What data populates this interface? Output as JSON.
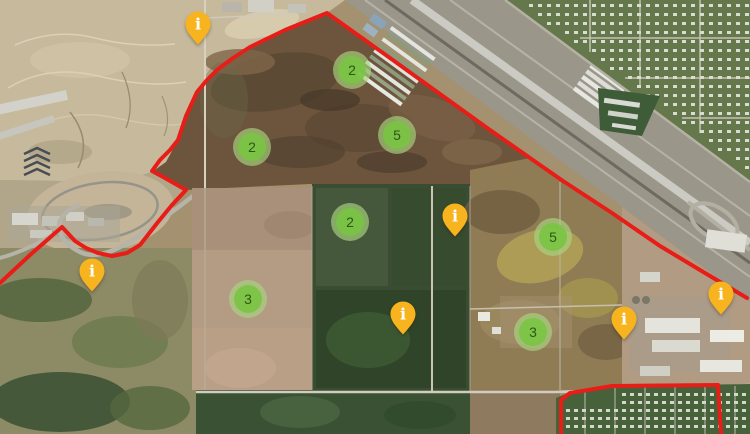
{
  "map": {
    "view": "satellite",
    "boundary_color": "#e81d18",
    "boundaries": {
      "main": [
        [
          0,
          283
        ],
        [
          30,
          255
        ],
        [
          62,
          227
        ],
        [
          75,
          241
        ],
        [
          86,
          248
        ],
        [
          98,
          253
        ],
        [
          112,
          256
        ],
        [
          127,
          253
        ],
        [
          140,
          245
        ],
        [
          158,
          222
        ],
        [
          172,
          205
        ],
        [
          186,
          190
        ],
        [
          165,
          178
        ],
        [
          152,
          171
        ],
        [
          160,
          160
        ],
        [
          170,
          150
        ],
        [
          178,
          140
        ],
        [
          186,
          116
        ],
        [
          197,
          92
        ],
        [
          207,
          80
        ],
        [
          217,
          70
        ],
        [
          233,
          58
        ],
        [
          250,
          47
        ],
        [
          285,
          30
        ],
        [
          327,
          13
        ],
        [
          390,
          58
        ],
        [
          440,
          94
        ],
        [
          490,
          130
        ],
        [
          540,
          165
        ],
        [
          563,
          181
        ],
        [
          612,
          213
        ],
        [
          660,
          246
        ],
        [
          705,
          273
        ],
        [
          747,
          298
        ]
      ],
      "secondary": [
        [
          561,
          434
        ],
        [
          561,
          400
        ],
        [
          570,
          393
        ],
        [
          612,
          386
        ],
        [
          718,
          385
        ],
        [
          721,
          434
        ]
      ]
    },
    "clusters": [
      {
        "count": "2",
        "x": 352,
        "y": 70
      },
      {
        "count": "5",
        "x": 397,
        "y": 135
      },
      {
        "count": "2",
        "x": 252,
        "y": 147
      },
      {
        "count": "2",
        "x": 350,
        "y": 222
      },
      {
        "count": "5",
        "x": 553,
        "y": 237
      },
      {
        "count": "3",
        "x": 248,
        "y": 299
      },
      {
        "count": "3",
        "x": 533,
        "y": 332
      }
    ],
    "cluster_style": {
      "fill": "rgba(121,196,66,0.9)",
      "ring": "rgba(168,213,127,0.66)",
      "text_color": "#2d5715"
    },
    "pins": [
      {
        "x": 198,
        "y": 45
      },
      {
        "x": 92,
        "y": 292
      },
      {
        "x": 455,
        "y": 237
      },
      {
        "x": 403,
        "y": 335
      },
      {
        "x": 624,
        "y": 340
      },
      {
        "x": 721,
        "y": 315
      }
    ],
    "pin_style": {
      "fill": "#f7b41e",
      "glyph": "i",
      "glyph_color": "#ffffff"
    }
  }
}
